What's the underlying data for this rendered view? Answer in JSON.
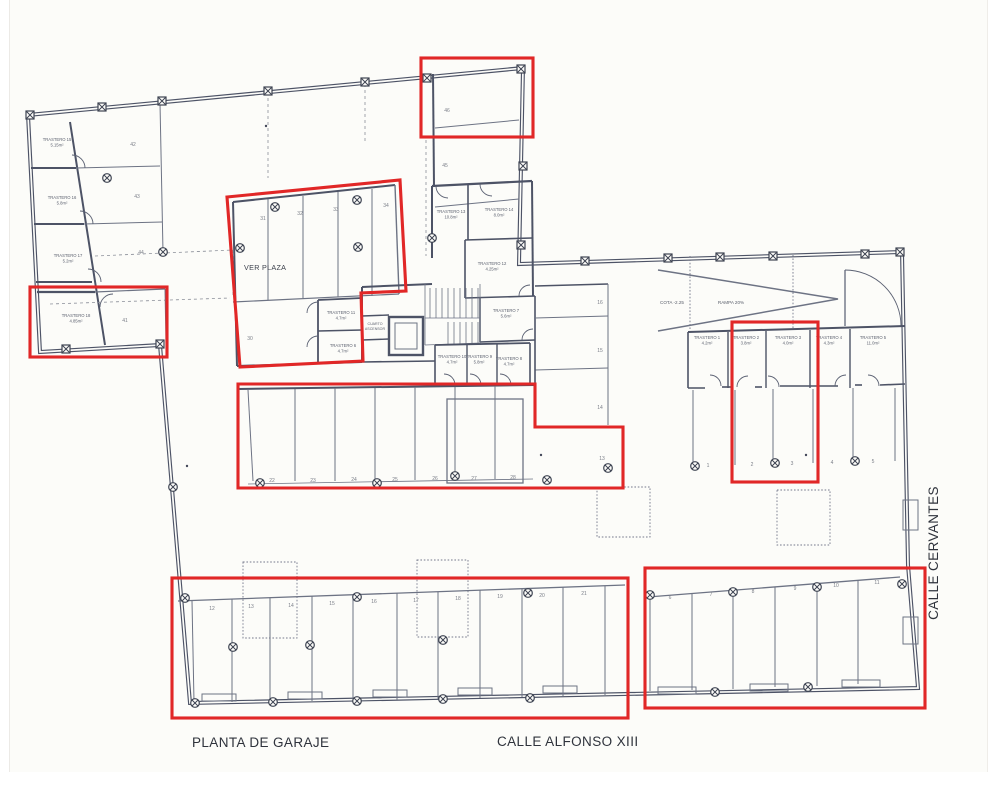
{
  "drawing": {
    "title": "PLANTA DE GARAJE",
    "street_bottom": "CALLE ALFONSO XIII",
    "street_right": "CALLE CERVANTES",
    "ver_plaza": "VER PLAZA",
    "rampa": "RAMPA 20%",
    "cota": "COTA -2.25",
    "ascensor_l1": "CUARTO",
    "ascensor_l2": "ASCENSOR"
  },
  "colors": {
    "highlight": "#e12727",
    "wall": "#4d5366",
    "paper": "#fcfcf9"
  },
  "rooms": [
    {
      "name": "TRASTERO 15",
      "area": "5.15m²"
    },
    {
      "name": "TRASTERO 16",
      "area": "5.8m²"
    },
    {
      "name": "TRASTERO 17",
      "area": "5.2m²"
    },
    {
      "name": "TRASTERO 18",
      "area": "4.85m²"
    },
    {
      "name": "TRASTERO 13",
      "area": "10.8m²"
    },
    {
      "name": "TRASTERO 14",
      "area": "8.0m²"
    },
    {
      "name": "TRASTERO 12",
      "area": "4.25m²"
    },
    {
      "name": "TRASTERO 11",
      "area": "4.7m²"
    },
    {
      "name": "TRASTERO 6",
      "area": "4.7m²"
    },
    {
      "name": "TRASTERO 7",
      "area": "5.6m²"
    },
    {
      "name": "TRASTERO 10",
      "area": "4.7m²"
    },
    {
      "name": "TRASTERO 9",
      "area": "5.8m²"
    },
    {
      "name": "TRASTERO 8",
      "area": "4.7m²"
    },
    {
      "name": "TRASTERO 1",
      "area": "4.2m²"
    },
    {
      "name": "TRASTERO 2",
      "area": "3.8m²"
    },
    {
      "name": "TRASTERO 3",
      "area": "4.0m²"
    },
    {
      "name": "TRASTERO 4",
      "area": "4.3m²"
    },
    {
      "name": "TRASTERO 5",
      "area": "11.0m²"
    }
  ],
  "spaces": {
    "nw": [
      "42",
      "43",
      "44"
    ],
    "north_wing": [
      "46",
      "45"
    ],
    "west_bay": "41",
    "ver_plaza_bays": [
      "31",
      "32",
      "33",
      "34"
    ],
    "ver_plaza_lower": "30",
    "mid_row": [
      "22",
      "23",
      "24",
      "25",
      "26",
      "27",
      "28"
    ],
    "east_stack": [
      "16",
      "15",
      "14",
      "13"
    ],
    "east_lower": [
      "1",
      "2",
      "3",
      "4",
      "5"
    ],
    "bottom_left": [
      "12",
      "13",
      "14",
      "15",
      "16",
      "17",
      "18",
      "19",
      "20",
      "21"
    ],
    "bottom_right": [
      "6",
      "7",
      "8",
      "9",
      "10",
      "11"
    ]
  }
}
